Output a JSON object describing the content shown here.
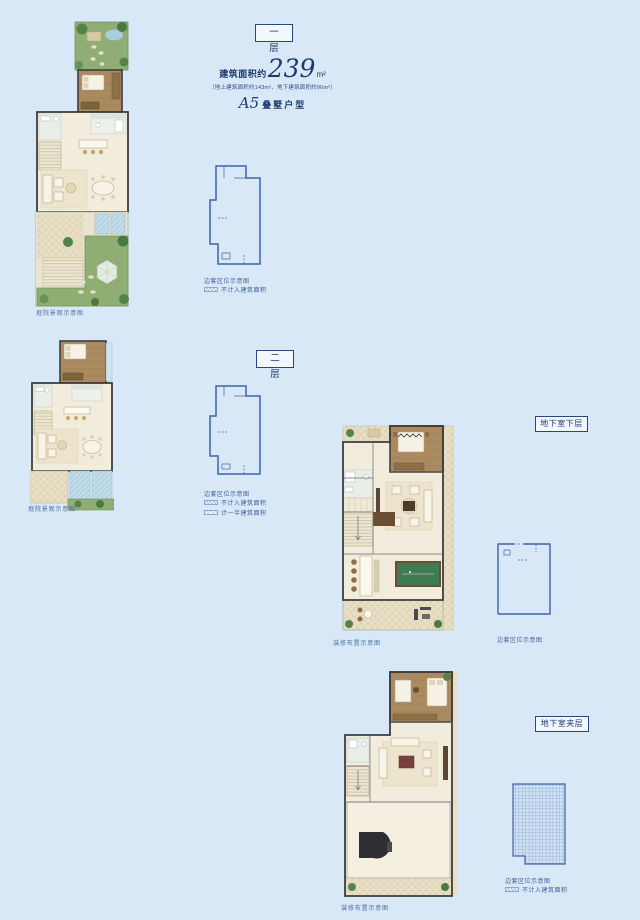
{
  "page": {
    "background": "#d9e8f6",
    "accent_navy": "#1d3a70",
    "keyline_blue": "#3c63a9"
  },
  "header": {
    "area_prefix": "建筑面积约",
    "area_value": "239",
    "area_unit": "m²",
    "area_detail": "（地上建筑面积约143m²、地下建筑面积约96m²）",
    "unit_model": "A5",
    "unit_type": "叠墅户型"
  },
  "floors": [
    {
      "label": "一 层",
      "caption": "庭院景观示意图",
      "legend_title": "边套区位示意图",
      "legend_items": [
        "不计入建筑面积"
      ]
    },
    {
      "label": "二 层",
      "caption": "庭院景观示意图",
      "legend_title": "边套区位示意图",
      "legend_items": [
        "不计入建筑面积",
        "计一半建筑面积"
      ]
    },
    {
      "label": "地下室下层",
      "caption": "装修布置示意图",
      "legend_title": "边套区位示意图",
      "legend_items": []
    },
    {
      "label": "地下室夹层",
      "caption": "装修布置示意图",
      "legend_title": "边套区位示意图",
      "legend_items": [
        "不计入建筑面积"
      ]
    }
  ]
}
